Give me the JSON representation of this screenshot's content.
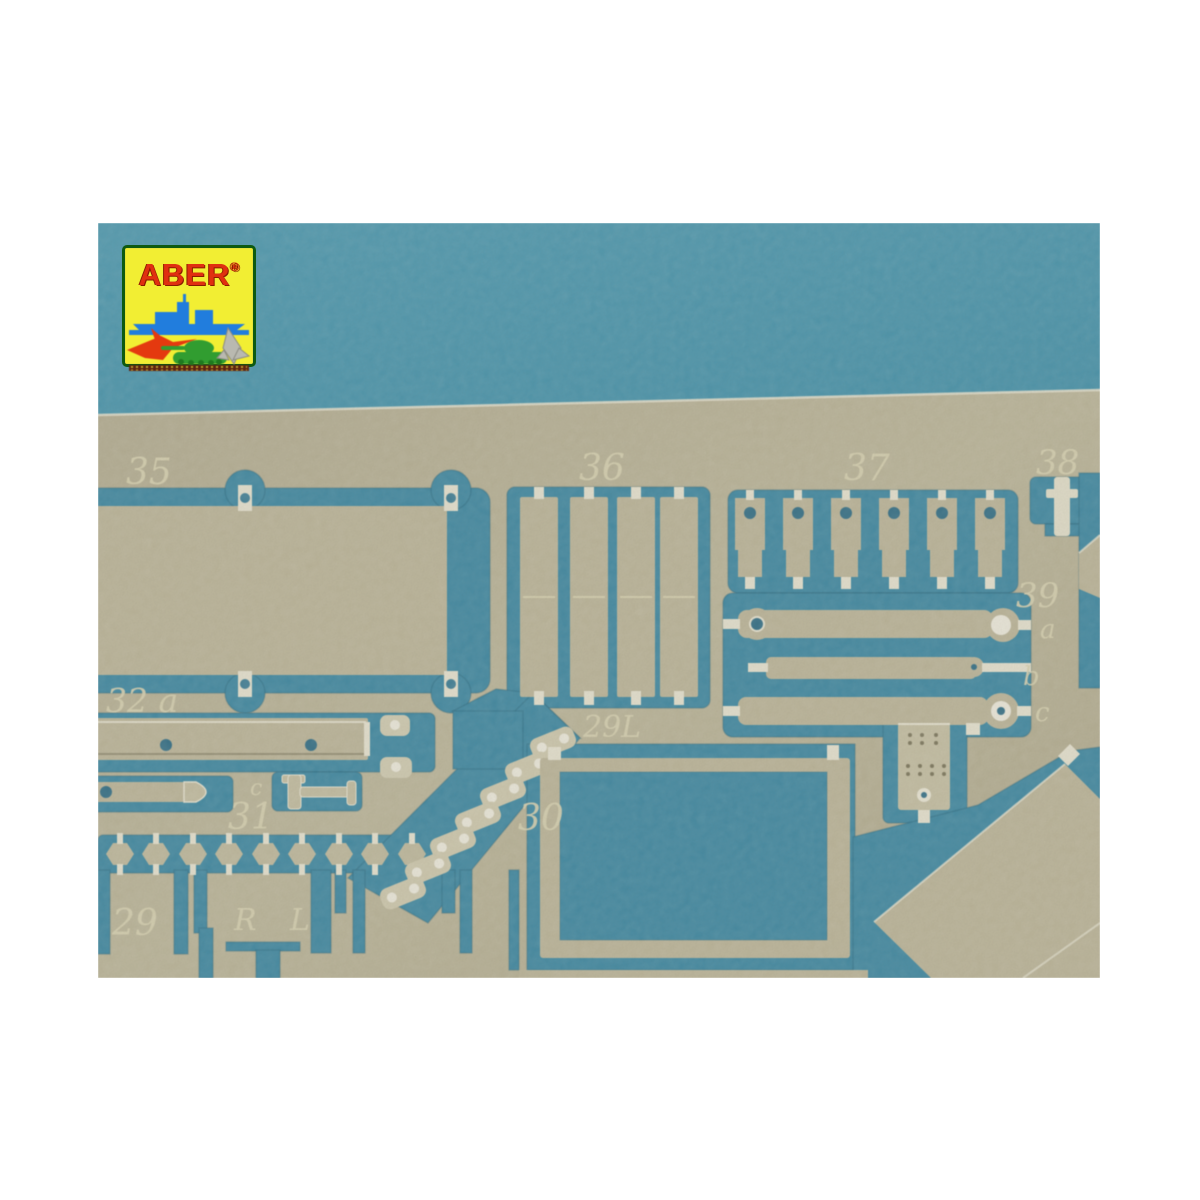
{
  "scene": {
    "description": "Product photo: ABER photo-etched brass model-detail fret lying on a blue background",
    "photo_region": {
      "left": 98,
      "top": 223,
      "width": 1002,
      "height": 755
    }
  },
  "logo": {
    "text": "ABER",
    "registered_mark": "®"
  },
  "colors": {
    "page_background": "#ffffff",
    "photo_blue": "#4295b2",
    "photo_blue_deep": "#3a8aa9",
    "fret_metal": "#bab394",
    "fret_bright_edge": "#ece8d6",
    "engraved_text": "#ddd7b6",
    "logo_yellow": "#f2ee33",
    "logo_border_green": "#0e5a10",
    "logo_text_red": "#e03010",
    "logo_ship_blue": "#1f7de0",
    "logo_jet_red": "#e8380d",
    "logo_tank_green": "#2f9e2e",
    "logo_track_brown": "#5f2310"
  },
  "fret_labels": {
    "p35": "35",
    "p36": "36",
    "p37": "37",
    "p38": "38",
    "p39": "39",
    "p39a": "a",
    "p39b": "b",
    "p39c": "c",
    "p32a": "32 a",
    "p31": "31",
    "p31c": "c",
    "p30": "30",
    "p29L": "29L",
    "p29": "29",
    "pR": "R",
    "pL": "L"
  }
}
